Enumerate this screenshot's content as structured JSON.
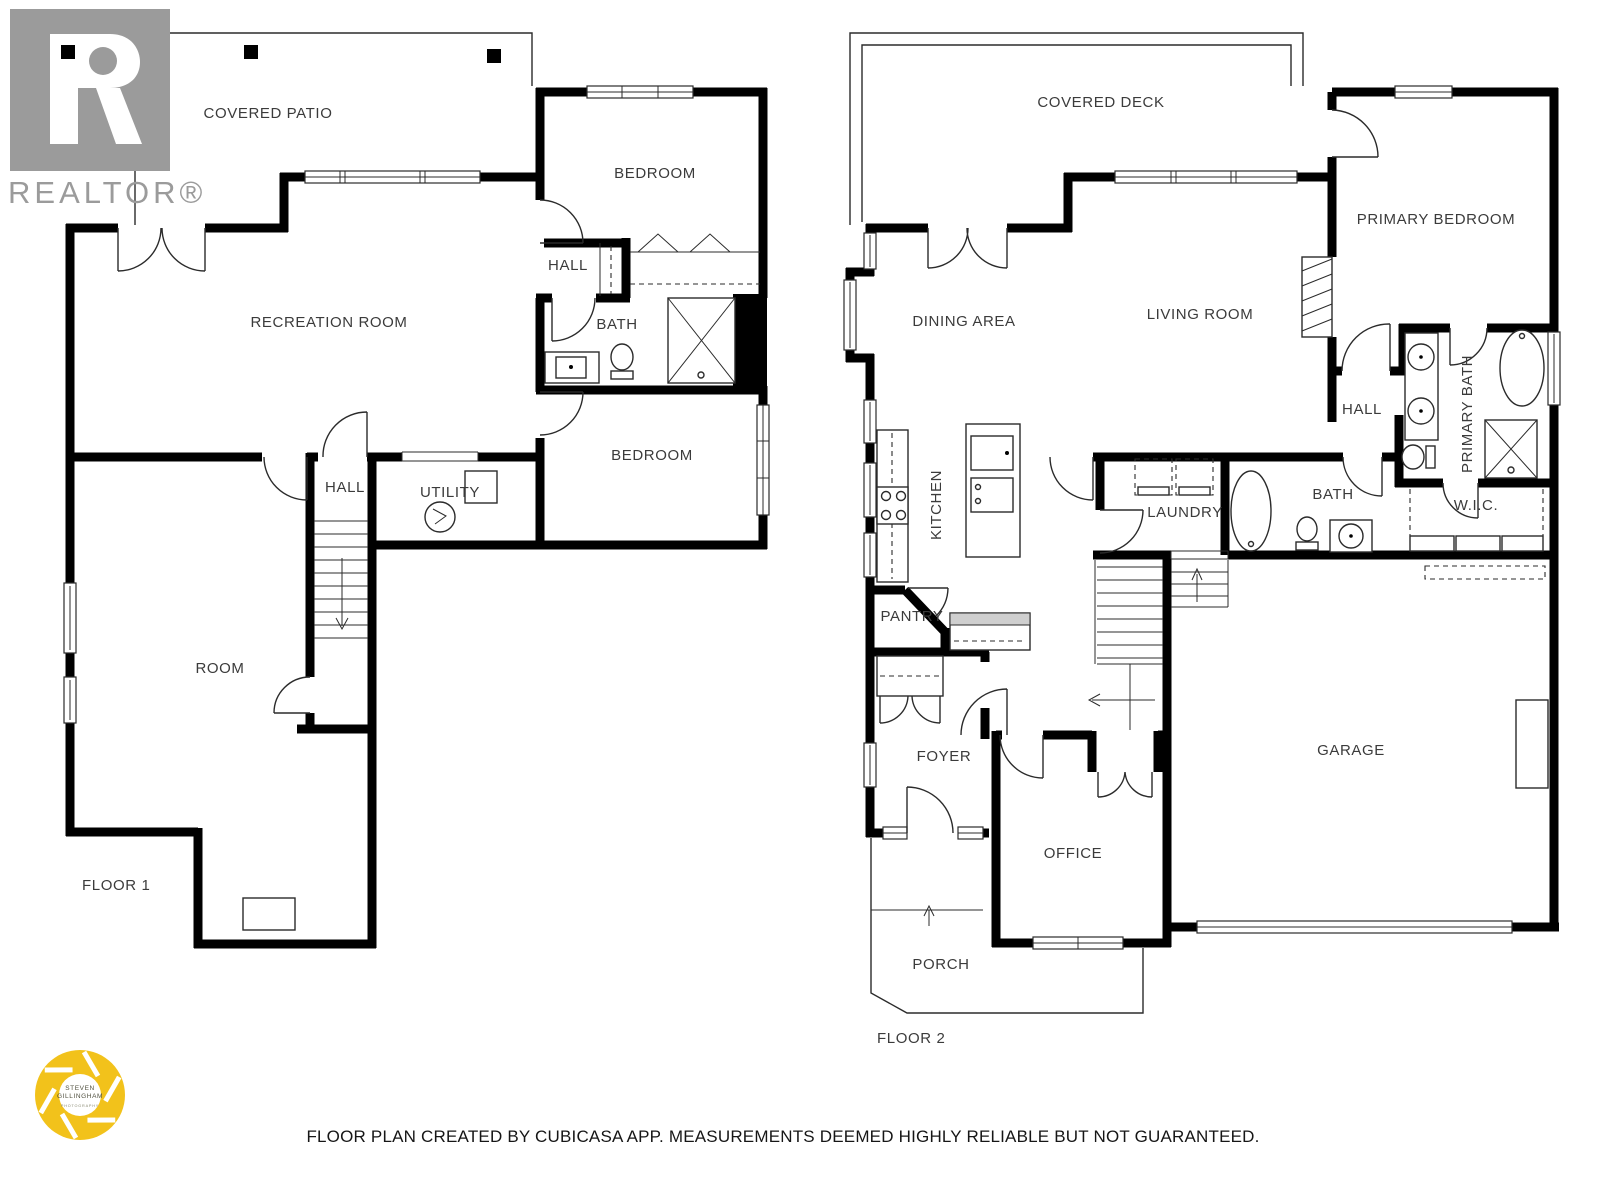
{
  "branding": {
    "realtor": {
      "wordmark": "REALTOR®"
    },
    "photographer": {
      "line1": "STEVEN",
      "line2": "GILLINGHAM",
      "line3": "PHOTOGRAPHY"
    }
  },
  "floor1": {
    "label": "FLOOR 1",
    "rooms": {
      "covered_patio": "COVERED PATIO",
      "recreation_room": "RECREATION ROOM",
      "bedroom_upper": "BEDROOM",
      "hall_upper": "HALL",
      "bath": "BATH",
      "bedroom_lower": "BEDROOM",
      "hall_lower": "HALL",
      "utility": "UTILITY",
      "room": "ROOM"
    }
  },
  "floor2": {
    "label": "FLOOR 2",
    "rooms": {
      "covered_deck": "COVERED DECK",
      "dining_area": "DINING AREA",
      "living_room": "LIVING ROOM",
      "primary_bedroom": "PRIMARY BEDROOM",
      "hall": "HALL",
      "primary_bath": "PRIMARY BATH",
      "kitchen": "KITCHEN",
      "laundry": "LAUNDRY",
      "bath": "BATH",
      "wic": "W.I.C.",
      "pantry": "PANTRY",
      "foyer": "FOYER",
      "office": "OFFICE",
      "garage": "GARAGE",
      "porch": "PORCH"
    }
  },
  "footer": {
    "disclaimer": "FLOOR PLAN CREATED BY CUBICASA APP. MEASUREMENTS DEEMED HIGHLY RELIABLE BUT NOT GUARANTEED."
  },
  "colors": {
    "wall": "#000000",
    "label": "#3b3b3b",
    "realtor_gray": "#9b9b9b",
    "photographer_yellow": "#F2C21B"
  }
}
